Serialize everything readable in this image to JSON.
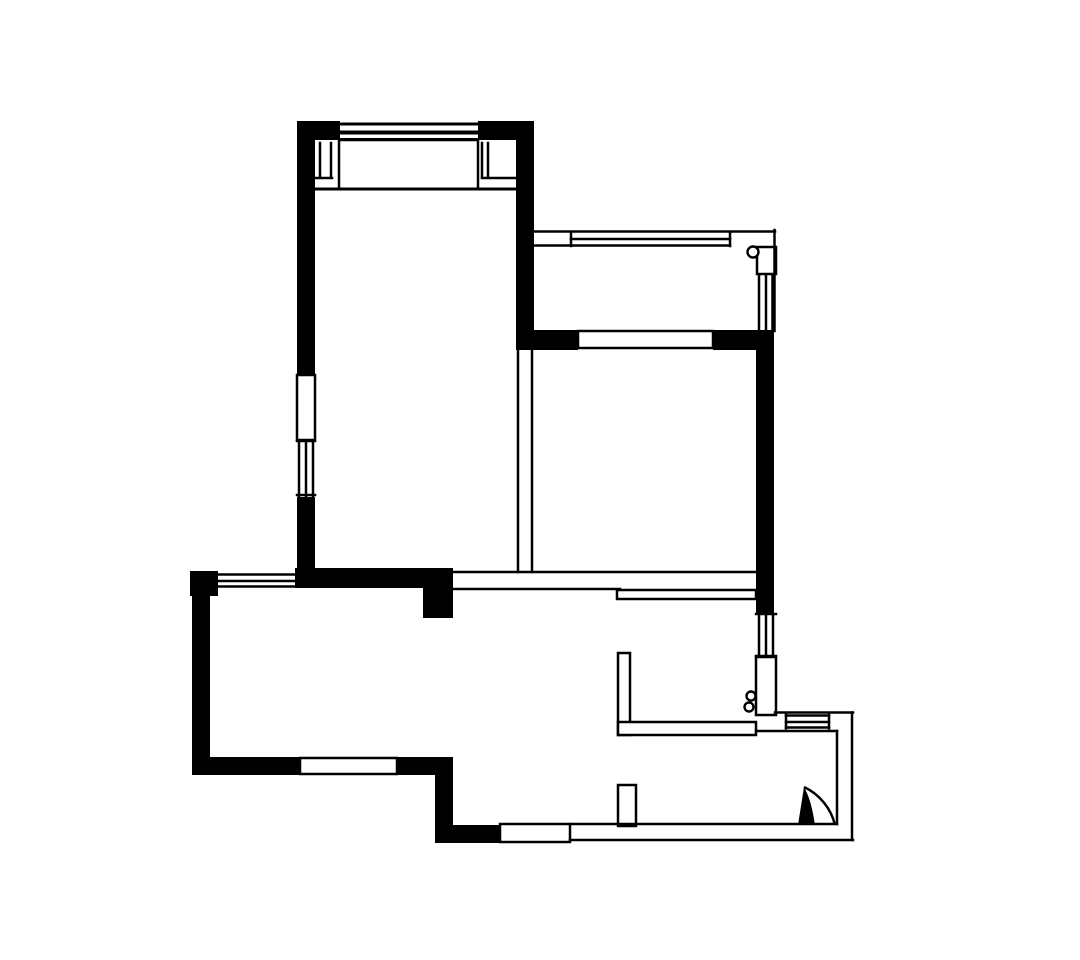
{
  "canvas": {
    "width": 1080,
    "height": 960,
    "background_color": "#ffffff",
    "ink_color": "#000000",
    "default_line_weight": 2.5
  },
  "floor_plan": {
    "structural_walls": [
      [
        297,
        121,
        18,
        256
      ],
      [
        297,
        497,
        18,
        75
      ],
      [
        297,
        121,
        43,
        19
      ],
      [
        478,
        121,
        56,
        19
      ],
      [
        516,
        121,
        18,
        229
      ],
      [
        190,
        571,
        28,
        25
      ],
      [
        295,
        568,
        158,
        20
      ],
      [
        423,
        588,
        30,
        30
      ],
      [
        192,
        571,
        18,
        204
      ],
      [
        192,
        757,
        108,
        18
      ],
      [
        397,
        757,
        56,
        18
      ],
      [
        435,
        775,
        18,
        68
      ],
      [
        435,
        825,
        65,
        18
      ],
      [
        516,
        330,
        62,
        20
      ],
      [
        713,
        330,
        61,
        20
      ],
      [
        756,
        330,
        18,
        283
      ]
    ],
    "light_partitions": [
      [
        297,
        375,
        18,
        65
      ],
      [
        339,
        140,
        139,
        49
      ],
      [
        578,
        331,
        135,
        17
      ],
      [
        757,
        247,
        19,
        27
      ],
      [
        756,
        657,
        20,
        58
      ],
      [
        617,
        590,
        139,
        9
      ],
      [
        618,
        653,
        12,
        82
      ],
      [
        618,
        722,
        138,
        13
      ],
      [
        618,
        785,
        18,
        41
      ],
      [
        300,
        758,
        97,
        16
      ],
      [
        500,
        824,
        70,
        18
      ]
    ],
    "detail_lines": [
      [
        340,
        124,
        477,
        124,
        3
      ],
      [
        340,
        132.5,
        477,
        132.5,
        4
      ],
      [
        340,
        139.5,
        477,
        139.5,
        3
      ],
      [
        320,
        143,
        320,
        177
      ],
      [
        331,
        143,
        331,
        177
      ],
      [
        316,
        178,
        332,
        178
      ],
      [
        482,
        143,
        482,
        177
      ],
      [
        488,
        143,
        488,
        177
      ],
      [
        482,
        178,
        516,
        178
      ],
      [
        315,
        189,
        517,
        189,
        3
      ],
      [
        299,
        441,
        299,
        496
      ],
      [
        306,
        441,
        306,
        496
      ],
      [
        313,
        441,
        313,
        496
      ],
      [
        297,
        441,
        315,
        441
      ],
      [
        297,
        495,
        315,
        495
      ],
      [
        218,
        574.5,
        297,
        574.5
      ],
      [
        218,
        581,
        297,
        581
      ],
      [
        218,
        586.5,
        297,
        586.5
      ],
      [
        535,
        231.5,
        775,
        231.5
      ],
      [
        571,
        239,
        730,
        239
      ],
      [
        535,
        245.5,
        730,
        245.5
      ],
      [
        571,
        232,
        571,
        246
      ],
      [
        730,
        232,
        730,
        246
      ],
      [
        774.5,
        230,
        774.5,
        331
      ],
      [
        759,
        275,
        759,
        330
      ],
      [
        766,
        275,
        766,
        330
      ],
      [
        772.5,
        275,
        772.5,
        330
      ],
      [
        759,
        615,
        759,
        655
      ],
      [
        766,
        615,
        766,
        655
      ],
      [
        773,
        615,
        773,
        655
      ],
      [
        756,
        614,
        776,
        614
      ],
      [
        756,
        656,
        776,
        656
      ],
      [
        453,
        572,
        757,
        572
      ],
      [
        453,
        589,
        620,
        589
      ],
      [
        518,
        350,
        518,
        572
      ],
      [
        532,
        350,
        532,
        572
      ],
      [
        775,
        712.5,
        853,
        712.5
      ],
      [
        852,
        712.5,
        852,
        840
      ],
      [
        570,
        840,
        853,
        840
      ],
      [
        570,
        824,
        837,
        824
      ],
      [
        837,
        731,
        837,
        824
      ],
      [
        756,
        731,
        837,
        731
      ],
      [
        786,
        715.5,
        829,
        715.5
      ],
      [
        786,
        722,
        829,
        722
      ],
      [
        786,
        727.5,
        829,
        727.5
      ],
      [
        786,
        714.5,
        786,
        728.5
      ],
      [
        829,
        714.5,
        829,
        728.5
      ]
    ],
    "drain_circles": [
      [
        753,
        252,
        5.5
      ],
      [
        751,
        696,
        4.5
      ],
      [
        749,
        707,
        4.5
      ]
    ],
    "entry_door": {
      "leaf_path": "M804 787 L798 825 L815 825 C812 806 809 796 804 787 Z",
      "swing_path": "M804 787 C819 794 831 808 835 825"
    }
  }
}
